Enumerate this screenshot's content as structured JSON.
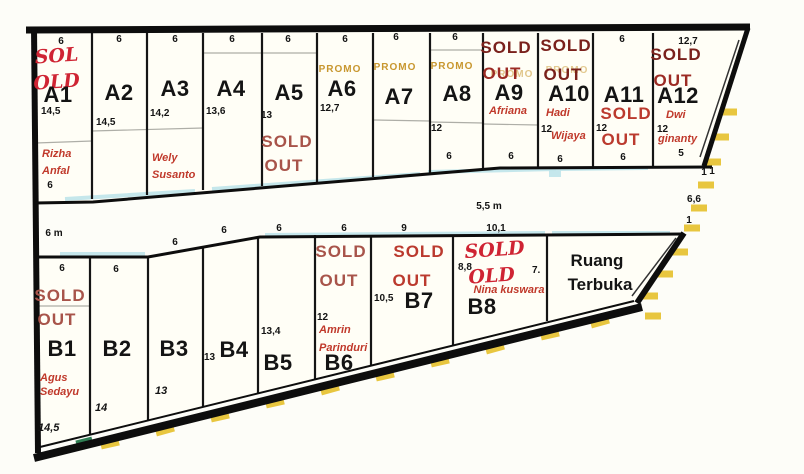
{
  "map_title": "Site plan kavling A/B",
  "colors": {
    "boundary_black": "#0d0d0d",
    "plot_fill": "#fffef6",
    "sold_dark_red": "#7a211c",
    "sold_red": "#a8544a",
    "sold_bright_red": "#bb3a2e",
    "handwritten_red": "#cf2433",
    "owner_red": "#c0392b",
    "promo_orange": "#c8972f",
    "hatch_yellow": "#e8c63f",
    "road_cyan": "#bfe4ea",
    "green_mark": "#2e7d52"
  },
  "row_a": [
    {
      "id": "A1",
      "top": "6",
      "status1": "SOL",
      "status2": "OLD",
      "label": "A1",
      "depth": "14,5",
      "owner1": "Rizha",
      "owner2": "Anfal",
      "bottom": "6"
    },
    {
      "id": "A2",
      "top": "6",
      "label": "A2",
      "depth": "14,5"
    },
    {
      "id": "A3",
      "top": "6",
      "label": "A3",
      "depth": "14,2",
      "owner1": "Wely",
      "owner2": "Susanto"
    },
    {
      "id": "A4",
      "top": "6",
      "label": "A4",
      "depth": "13,6"
    },
    {
      "id": "A5",
      "top": "6",
      "label": "A5",
      "depth": "13",
      "status1": "SOLD",
      "status2": "OUT"
    },
    {
      "id": "A6",
      "top": "6",
      "promo": "PROMO",
      "label": "A6",
      "depth": "12,7"
    },
    {
      "id": "A7",
      "top": "6",
      "promo": "PROMO",
      "label": "A7"
    },
    {
      "id": "A8",
      "top": "6",
      "promo": "PROMO",
      "label": "A8",
      "depth": "12",
      "bottom": "6"
    },
    {
      "id": "A9",
      "status1": "SOLD",
      "status2": "OUT",
      "promo_ghost": "PROMO",
      "label": "A9",
      "owner1": "Afriana",
      "bottom": "6"
    },
    {
      "id": "A10",
      "status1": "SOLD",
      "status2": "OUT",
      "promo_ghost": "PROMO",
      "label": "A10",
      "owner1": "Hadi",
      "depth": "12",
      "owner2": "Wijaya",
      "bottom": "6"
    },
    {
      "id": "A11",
      "top": "6",
      "label": "A11",
      "status1": "SOLD",
      "status2": "OUT",
      "depth": "12",
      "bottom": "6"
    },
    {
      "id": "A12",
      "top": "12,7",
      "status1": "SOLD",
      "status2": "OUT",
      "label": "A12",
      "depth": "12",
      "owner1": "Dwi",
      "owner2": "ginanty",
      "bottom": "5",
      "corner": "1"
    }
  ],
  "row_b": [
    {
      "id": "B1",
      "top": "6",
      "status1": "SOLD",
      "status2": "OUT",
      "label": "B1",
      "owner1": "Agus",
      "owner2": "Sedayu",
      "depth": "14,5"
    },
    {
      "id": "B2",
      "top": "6",
      "label": "B2",
      "depth": "14"
    },
    {
      "id": "B3",
      "top": "6",
      "label": "B3",
      "depth": "13"
    },
    {
      "id": "B4",
      "top": "6",
      "width": "13",
      "label": "B4"
    },
    {
      "id": "B5",
      "top": "6",
      "depth": "13,4",
      "label": "B5"
    },
    {
      "id": "B6",
      "top": "6",
      "status1": "SOLD",
      "status2": "OUT",
      "depth": "12",
      "owner1": "Amrin",
      "owner2": "Parinduri",
      "label": "B6"
    },
    {
      "id": "B7",
      "top": "9",
      "status1": "SOLD",
      "status2": "OUT",
      "depth": "10,5",
      "label": "B7"
    },
    {
      "id": "B8",
      "top": "10,1",
      "status1": "SOLD",
      "status2": "OLD",
      "owner1": "Nina kuswara",
      "depth": "8,8",
      "side": "7.",
      "label": "B8"
    }
  ],
  "road": {
    "left_width": "6 m",
    "right_width": "5,5 m"
  },
  "open_space": {
    "line1": "Ruang",
    "line2": "Terbuka"
  },
  "right_edge": {
    "top": "1",
    "mid": "6,6",
    "bottom": "1"
  }
}
